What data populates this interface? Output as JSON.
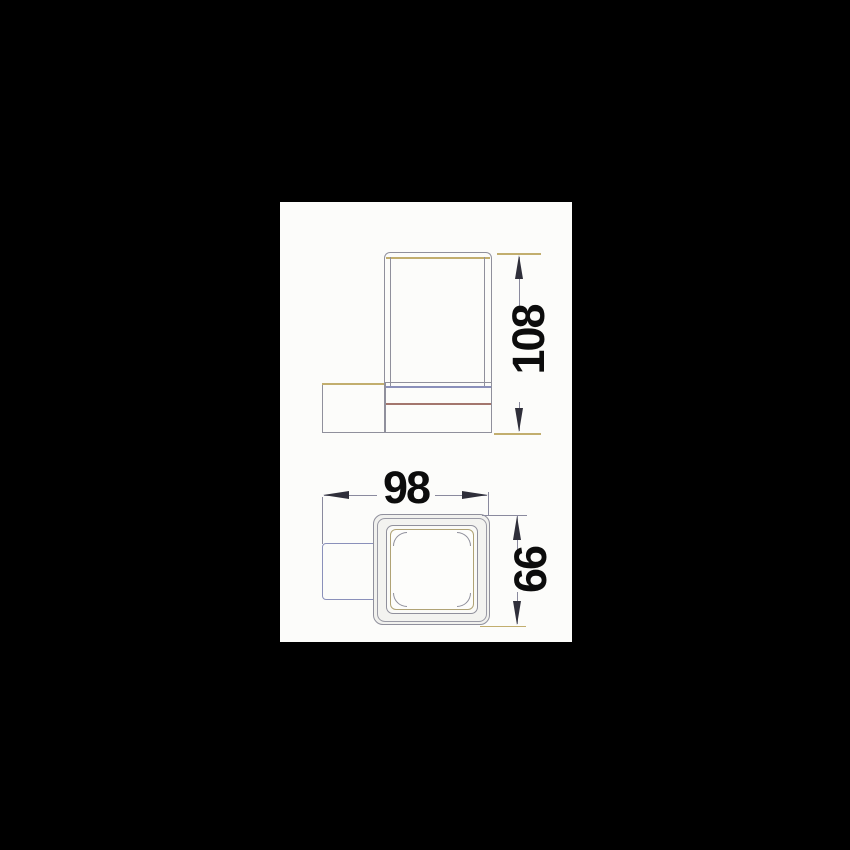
{
  "sheet": {
    "background": "#000000",
    "paper_color": "#fcfcfa"
  },
  "dimensions": {
    "height": "108",
    "width": "98",
    "depth": "66"
  },
  "palette": {
    "line": "#90909c",
    "line_warm": "#c2ae6e",
    "line_cool": "#8a90ba",
    "line_red": "#a3766d",
    "dimension_line": "#8a8a9e",
    "arrow": "#2f2f3a",
    "label": "#0c0c0c"
  }
}
